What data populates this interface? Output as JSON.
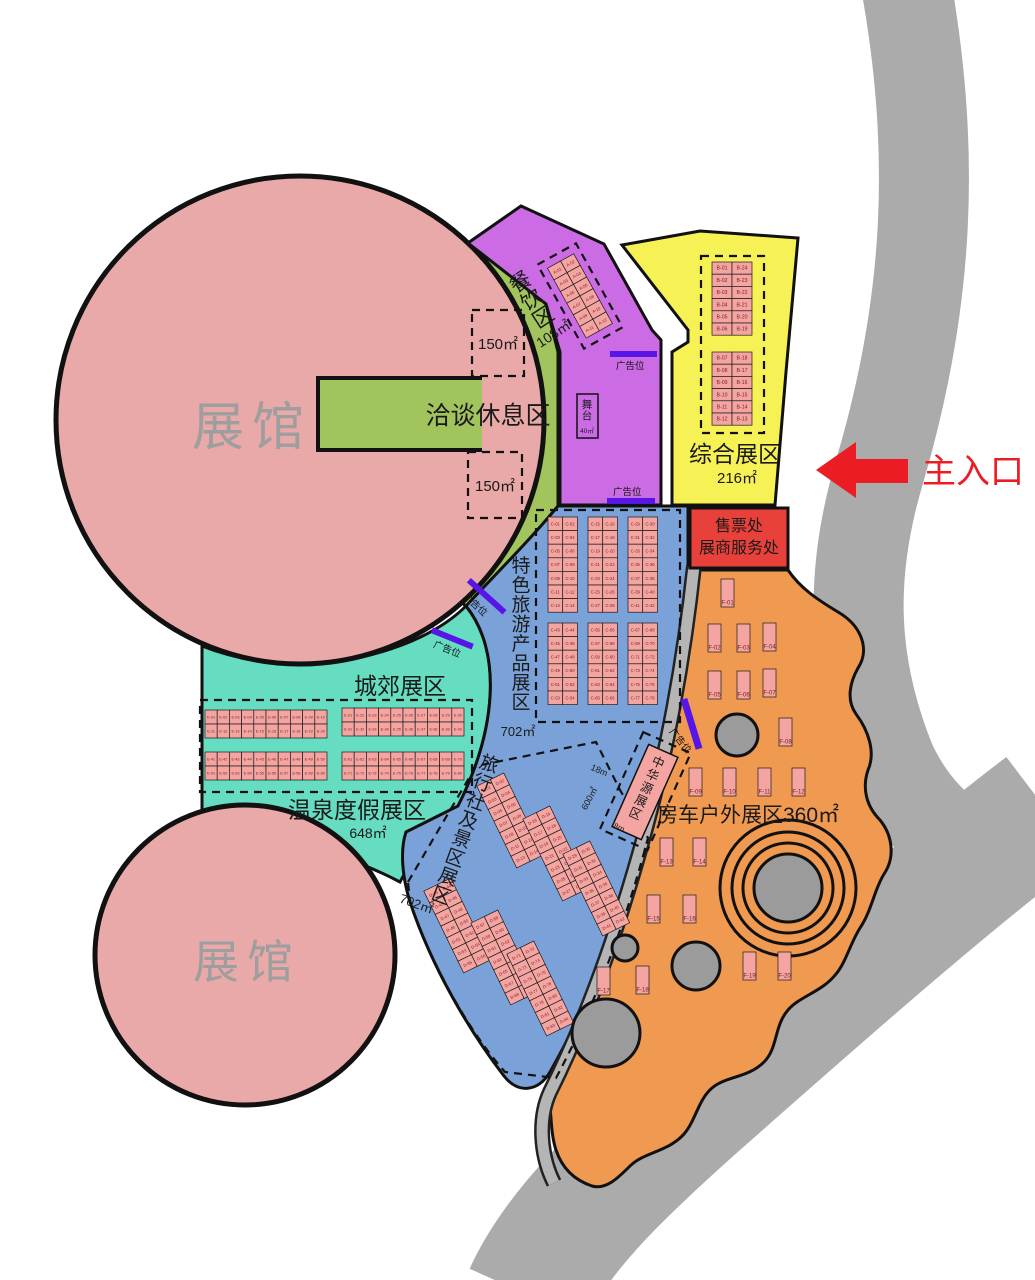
{
  "halls": {
    "top": "展馆",
    "bottom": "展馆"
  },
  "entrance": {
    "label": "主入口"
  },
  "ad_label": "广告位",
  "colors": {
    "hall_pink": "#e8a9a8",
    "green": "#a2c45c",
    "purple": "#cb6ce5",
    "yellow": "#f6f154",
    "red_box": "#e8403a",
    "blue": "#7ba2d8",
    "teal": "#66dcc1",
    "orange": "#f09a51",
    "booth_pink": "#f4a5a2",
    "ad_bar": "#5716e8",
    "road_gray": "#ababab",
    "arrow_red": "#ec1c24"
  },
  "zones": {
    "negotiation": {
      "name": "洽谈休息区",
      "box1": "150㎡",
      "box2": "150㎡"
    },
    "dining": {
      "name": "餐饮区",
      "area": "108㎡",
      "grid": {
        "prefix": "A"
      }
    },
    "stage": {
      "name": "舞台",
      "area": "40㎡"
    },
    "comprehensive": {
      "name": "综合展区",
      "area": "216㎡",
      "grid": {
        "labels": [
          "B-01",
          "B-24",
          "B-02",
          "B-23",
          "B-03",
          "B-22",
          "B-04",
          "B-21",
          "B-05",
          "B-20",
          "B-06",
          "B-19",
          "B-07",
          "B-18",
          "B-08",
          "B-17",
          "B-09",
          "B-16",
          "B-10",
          "B-15",
          "B-11",
          "B-14",
          "B-12",
          "B-13"
        ]
      }
    },
    "ticket": {
      "line1": "售票处",
      "line2": "展商服务处"
    },
    "special": {
      "name": "特色旅游产品展区",
      "area": "702㎡",
      "grid": {
        "prefix": "C"
      }
    },
    "suburban": {
      "name": "城郊展区"
    },
    "hotspring": {
      "name": "温泉度假展区",
      "area": "648㎡",
      "grid": {
        "prefix": "E"
      }
    },
    "travel": {
      "name": "旅行社及景区展区",
      "area": "702㎡",
      "grid": {
        "prefix": "D"
      }
    },
    "zhonghua": {
      "name": "中华源展区",
      "width": "18m",
      "area": "600㎡",
      "depth": "8m"
    },
    "rv": {
      "name": "房车户外展区360㎡",
      "booths": [
        {
          "x": 721,
          "y": 579,
          "label": "F-01"
        },
        {
          "x": 708,
          "y": 624,
          "label": "F-02"
        },
        {
          "x": 737,
          "y": 624,
          "label": "F-03"
        },
        {
          "x": 763,
          "y": 623,
          "label": "F-04"
        },
        {
          "x": 708,
          "y": 671,
          "label": "F-05"
        },
        {
          "x": 737,
          "y": 671,
          "label": "F-06"
        },
        {
          "x": 763,
          "y": 669,
          "label": "F-07"
        },
        {
          "x": 779,
          "y": 718,
          "label": "F-08"
        },
        {
          "x": 689,
          "y": 768,
          "label": "F-09"
        },
        {
          "x": 723,
          "y": 768,
          "label": "F-10"
        },
        {
          "x": 758,
          "y": 768,
          "label": "F-11"
        },
        {
          "x": 792,
          "y": 768,
          "label": "F-12"
        },
        {
          "x": 660,
          "y": 838,
          "label": "F-13"
        },
        {
          "x": 693,
          "y": 838,
          "label": "F-14"
        },
        {
          "x": 647,
          "y": 895,
          "label": "F-15"
        },
        {
          "x": 683,
          "y": 895,
          "label": "F-16"
        },
        {
          "x": 597,
          "y": 967,
          "label": "F-17"
        },
        {
          "x": 636,
          "y": 966,
          "label": "F-18"
        },
        {
          "x": 743,
          "y": 952,
          "label": "F-19"
        },
        {
          "x": 778,
          "y": 952,
          "label": "F-20"
        }
      ]
    }
  }
}
